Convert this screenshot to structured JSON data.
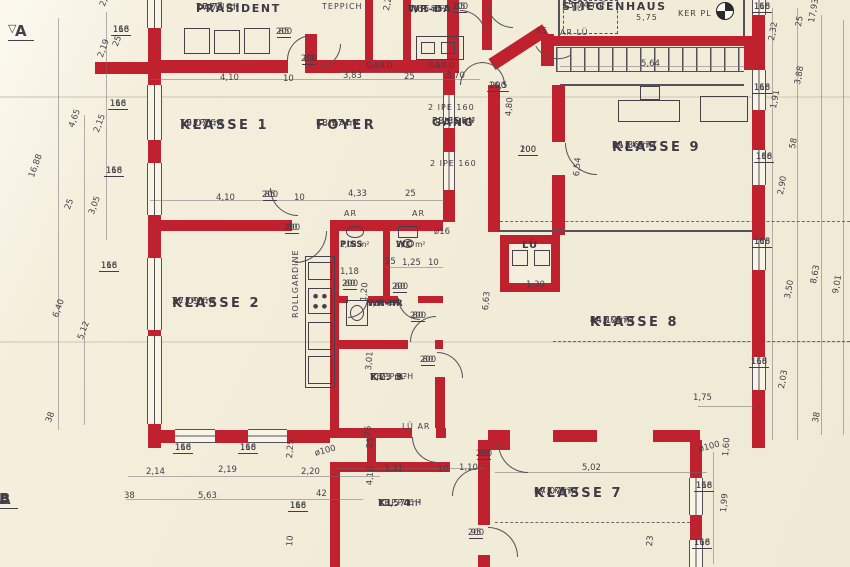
{
  "colors": {
    "wall_red": "#c0212e",
    "paper": "#f2edda",
    "ink": "#45404c"
  },
  "markers": {
    "a": "A",
    "b": "B"
  },
  "rooms": [
    {
      "id": "praesident",
      "name": "PRÄSIDENT",
      "area": "17,74 m²",
      "floor": "TEPPICH",
      "x": 196,
      "y": 2,
      "sz": "md"
    },
    {
      "id": "wr-da",
      "name": "WR-DA",
      "area": "4,65 m²",
      "floor": "FLIESEN",
      "x": 408,
      "y": 4,
      "sz": "sm"
    },
    {
      "id": "stiegenhaus",
      "name": "STIEGENHAUS",
      "area": "15,74 m²",
      "floor": "",
      "x": 562,
      "y": 0,
      "sz": "md"
    },
    {
      "id": "klasse-1",
      "name": "KLASSE 1",
      "area": "19,07 m²",
      "floor": "TEPPICH",
      "x": 180,
      "y": 118,
      "sz": "lg"
    },
    {
      "id": "foyer",
      "name": "FOYER",
      "area": "18,97 m²",
      "floor": "FLIESEN",
      "x": 316,
      "y": 118,
      "sz": "lg"
    },
    {
      "id": "gang",
      "name": "GANG",
      "area": "38,85 m²",
      "floor": "FLIESEN",
      "x": 432,
      "y": 116,
      "sz": "md"
    },
    {
      "id": "klasse-9",
      "name": "KLASSE 9",
      "area": "31,86 m²",
      "floor": "PARKETT",
      "x": 612,
      "y": 140,
      "sz": "lg"
    },
    {
      "id": "klasse-2",
      "name": "KLASSE 2",
      "area": "37,09 m²",
      "floor": "TEPPICH",
      "x": 172,
      "y": 296,
      "sz": "lg"
    },
    {
      "id": "piss",
      "name": "PISS",
      "area": "2,08 m²",
      "floor": "",
      "x": 340,
      "y": 240,
      "sz": "xs"
    },
    {
      "id": "wc",
      "name": "WC",
      "area": "2,00 m²",
      "floor": "",
      "x": 396,
      "y": 240,
      "sz": "xs"
    },
    {
      "id": "wr-hr",
      "name": "WR-HR",
      "area": "3,18 m²",
      "floor": "FLIESEN",
      "x": 368,
      "y": 299,
      "sz": "xs"
    },
    {
      "id": "lue-shaft",
      "name": "LÜ",
      "area": "",
      "floor": "",
      "x": 522,
      "y": 240,
      "sz": "sm"
    },
    {
      "id": "kl-3",
      "name": "KL. 3",
      "area": "8,73 m²",
      "floor": "TEPPICH",
      "x": 370,
      "y": 372,
      "sz": "sm"
    },
    {
      "id": "klasse-8",
      "name": "KLASSE 8",
      "area": "44,12 m²",
      "floor": "PARKETT",
      "x": 590,
      "y": 315,
      "sz": "lg"
    },
    {
      "id": "kl-4",
      "name": "KL. 4",
      "area": "13,57 m²",
      "floor": "TEPPICH",
      "x": 378,
      "y": 498,
      "sz": "sm"
    },
    {
      "id": "klasse-7",
      "name": "KLASSE 7",
      "area": "17,07 m²",
      "floor": "PARKETT",
      "x": 534,
      "y": 486,
      "sz": "lg"
    }
  ],
  "annotations": [
    {
      "t": "TEPPICH",
      "x": 322,
      "y": 3
    },
    {
      "t": "GARD",
      "x": 366,
      "y": 62
    },
    {
      "t": "GARD",
      "x": 428,
      "y": 62
    },
    {
      "t": "2 IPE 160",
      "x": 428,
      "y": 104
    },
    {
      "t": "2 IPE 160",
      "x": 430,
      "y": 160
    },
    {
      "t": "AR",
      "x": 344,
      "y": 210
    },
    {
      "t": "AR",
      "x": 412,
      "y": 210
    },
    {
      "t": "LÜ AR",
      "x": 402,
      "y": 423
    },
    {
      "t": "85",
      "x": 536,
      "y": 27
    },
    {
      "t": "AR LÜ",
      "x": 560,
      "y": 29
    },
    {
      "t": "LÜ",
      "x": 572,
      "y": 5
    },
    {
      "t": "5,75",
      "x": 636,
      "y": 14
    },
    {
      "t": "KER PL",
      "x": 678,
      "y": 10
    },
    {
      "t": "ROLLGARDINE",
      "x": 292,
      "y": 318,
      "r": -90
    }
  ],
  "dims": [
    {
      "t": "2,4",
      "x": 99,
      "y": 5,
      "r": -70
    },
    {
      "t": "116",
      "b": "168",
      "x": 121,
      "y": 26
    },
    {
      "t": "25",
      "x": 112,
      "y": 45,
      "r": -70
    },
    {
      "t": "2,19",
      "x": 97,
      "y": 56,
      "r": -70
    },
    {
      "t": "4,65",
      "x": 68,
      "y": 126,
      "r": -70
    },
    {
      "t": "2,15",
      "x": 93,
      "y": 131,
      "r": -70
    },
    {
      "t": "16,88",
      "x": 28,
      "y": 176,
      "r": -70
    },
    {
      "t": "116",
      "b": "168",
      "x": 118,
      "y": 100
    },
    {
      "t": "116",
      "b": "168",
      "x": 114,
      "y": 167
    },
    {
      "t": "25",
      "x": 64,
      "y": 208,
      "r": -70
    },
    {
      "t": "3,05",
      "x": 88,
      "y": 213,
      "r": -70
    },
    {
      "t": "116",
      "b": "168",
      "x": 109,
      "y": 262
    },
    {
      "t": "6,40",
      "x": 52,
      "y": 316,
      "r": -70
    },
    {
      "t": "5,12",
      "x": 77,
      "y": 338,
      "r": -70
    },
    {
      "t": "38",
      "x": 45,
      "y": 421,
      "r": -70
    },
    {
      "t": "85",
      "b": "200",
      "x": 284,
      "y": 28
    },
    {
      "t": "80",
      "b": "200",
      "x": 309,
      "y": 55
    },
    {
      "t": "4,10",
      "x": 220,
      "y": 74
    },
    {
      "t": "10",
      "x": 283,
      "y": 75
    },
    {
      "t": "3,83",
      "x": 343,
      "y": 72
    },
    {
      "t": "25",
      "x": 404,
      "y": 73
    },
    {
      "t": "3,70",
      "x": 446,
      "y": 72
    },
    {
      "t": "2,25",
      "x": 383,
      "y": 10,
      "r": -80
    },
    {
      "t": "85",
      "b": "200",
      "x": 460,
      "y": 3
    },
    {
      "t": "5,64",
      "x": 641,
      "y": 60
    },
    {
      "t": "116",
      "b": "168",
      "x": 762,
      "y": 3
    },
    {
      "t": "2,32",
      "x": 768,
      "y": 40,
      "r": -80
    },
    {
      "t": "25",
      "x": 795,
      "y": 26,
      "r": -80
    },
    {
      "t": "17,93",
      "x": 808,
      "y": 22,
      "r": -80
    },
    {
      "t": "116",
      "b": "168",
      "x": 762,
      "y": 84
    },
    {
      "t": "3,88",
      "x": 794,
      "y": 84,
      "r": -80
    },
    {
      "t": "1,91",
      "x": 770,
      "y": 108,
      "r": -80
    },
    {
      "t": "116",
      "b": "168",
      "x": 764,
      "y": 153
    },
    {
      "t": "58",
      "x": 789,
      "y": 148,
      "r": -80
    },
    {
      "t": "2,90",
      "x": 777,
      "y": 194,
      "r": -80
    },
    {
      "t": "116",
      "b": "168",
      "x": 762,
      "y": 238
    },
    {
      "t": "3,50",
      "x": 784,
      "y": 298,
      "r": -80
    },
    {
      "t": "8,63",
      "x": 810,
      "y": 283,
      "r": -80
    },
    {
      "t": "9,01",
      "x": 832,
      "y": 293,
      "r": -80
    },
    {
      "t": "116",
      "b": "168",
      "x": 759,
      "y": 358
    },
    {
      "t": "2,03",
      "x": 778,
      "y": 388,
      "r": -80
    },
    {
      "t": "38",
      "x": 812,
      "y": 422,
      "r": -80
    },
    {
      "t": "16,5",
      "b": "200",
      "x": 498,
      "y": 82
    },
    {
      "t": "4,80",
      "x": 505,
      "y": 116,
      "r": -85
    },
    {
      "t": "100",
      "b": "200",
      "x": 528,
      "y": 146
    },
    {
      "t": "6,54",
      "x": 573,
      "y": 176,
      "r": -85
    },
    {
      "t": "1,30",
      "x": 526,
      "y": 281
    },
    {
      "t": "6,63",
      "x": 482,
      "y": 310,
      "r": -85
    },
    {
      "t": "4,10",
      "x": 216,
      "y": 194
    },
    {
      "t": "85",
      "b": "200",
      "x": 270,
      "y": 191
    },
    {
      "t": "10",
      "x": 294,
      "y": 194
    },
    {
      "t": "4,33",
      "x": 348,
      "y": 190
    },
    {
      "t": "25",
      "x": 405,
      "y": 190
    },
    {
      "t": "90",
      "b": "200",
      "x": 292,
      "y": 224
    },
    {
      "t": "ø16",
      "x": 434,
      "y": 228
    },
    {
      "t": "1,18",
      "x": 340,
      "y": 268
    },
    {
      "t": "25",
      "x": 385,
      "y": 258
    },
    {
      "t": "1,25",
      "x": 402,
      "y": 259
    },
    {
      "t": "10",
      "x": 428,
      "y": 259
    },
    {
      "t": "60",
      "b": "200",
      "x": 350,
      "y": 280
    },
    {
      "t": "60",
      "b": "200",
      "x": 400,
      "y": 283
    },
    {
      "t": "1,20",
      "x": 360,
      "y": 301,
      "r": -85
    },
    {
      "t": "80",
      "b": "200",
      "x": 418,
      "y": 312
    },
    {
      "t": "3,01",
      "x": 365,
      "y": 370,
      "r": -85
    },
    {
      "t": "80",
      "b": "200",
      "x": 428,
      "y": 356
    },
    {
      "t": "25",
      "x": 364,
      "y": 436,
      "r": -85
    },
    {
      "t": "3,31",
      "x": 384,
      "y": 465
    },
    {
      "t": "10",
      "x": 438,
      "y": 466
    },
    {
      "t": "1,10",
      "x": 459,
      "y": 464
    },
    {
      "t": "90",
      "b": "200",
      "x": 484,
      "y": 450
    },
    {
      "t": "4,10",
      "x": 366,
      "y": 485,
      "r": -85
    },
    {
      "t": "95",
      "b": "200",
      "x": 476,
      "y": 529
    },
    {
      "t": "5,02",
      "x": 582,
      "y": 464
    },
    {
      "t": "116",
      "b": "168",
      "x": 183,
      "y": 444
    },
    {
      "t": "116",
      "b": "168",
      "x": 248,
      "y": 444
    },
    {
      "t": "2,14",
      "x": 146,
      "y": 468
    },
    {
      "t": "2,19",
      "x": 218,
      "y": 466
    },
    {
      "t": "2,25",
      "x": 286,
      "y": 458,
      "r": -85
    },
    {
      "t": "2,20",
      "x": 301,
      "y": 468
    },
    {
      "t": "ø100",
      "x": 314,
      "y": 450,
      "r": -15
    },
    {
      "t": "5,63",
      "x": 198,
      "y": 492
    },
    {
      "t": "38",
      "x": 124,
      "y": 492
    },
    {
      "t": "42",
      "x": 316,
      "y": 490
    },
    {
      "t": "116",
      "b": "168",
      "x": 298,
      "y": 502
    },
    {
      "t": "10",
      "x": 286,
      "y": 546,
      "r": -85
    },
    {
      "t": "25",
      "x": 366,
      "y": 448,
      "r": -85
    },
    {
      "t": "1,75",
      "x": 693,
      "y": 394
    },
    {
      "t": "ø100",
      "x": 698,
      "y": 446,
      "r": -15
    },
    {
      "t": "1,60",
      "x": 722,
      "y": 456,
      "r": -85
    },
    {
      "t": "116",
      "b": "168",
      "x": 704,
      "y": 482
    },
    {
      "t": "1,99",
      "x": 720,
      "y": 512,
      "r": -85
    },
    {
      "t": "116",
      "b": "168",
      "x": 702,
      "y": 539
    },
    {
      "t": "23",
      "x": 646,
      "y": 546,
      "r": -85
    }
  ]
}
